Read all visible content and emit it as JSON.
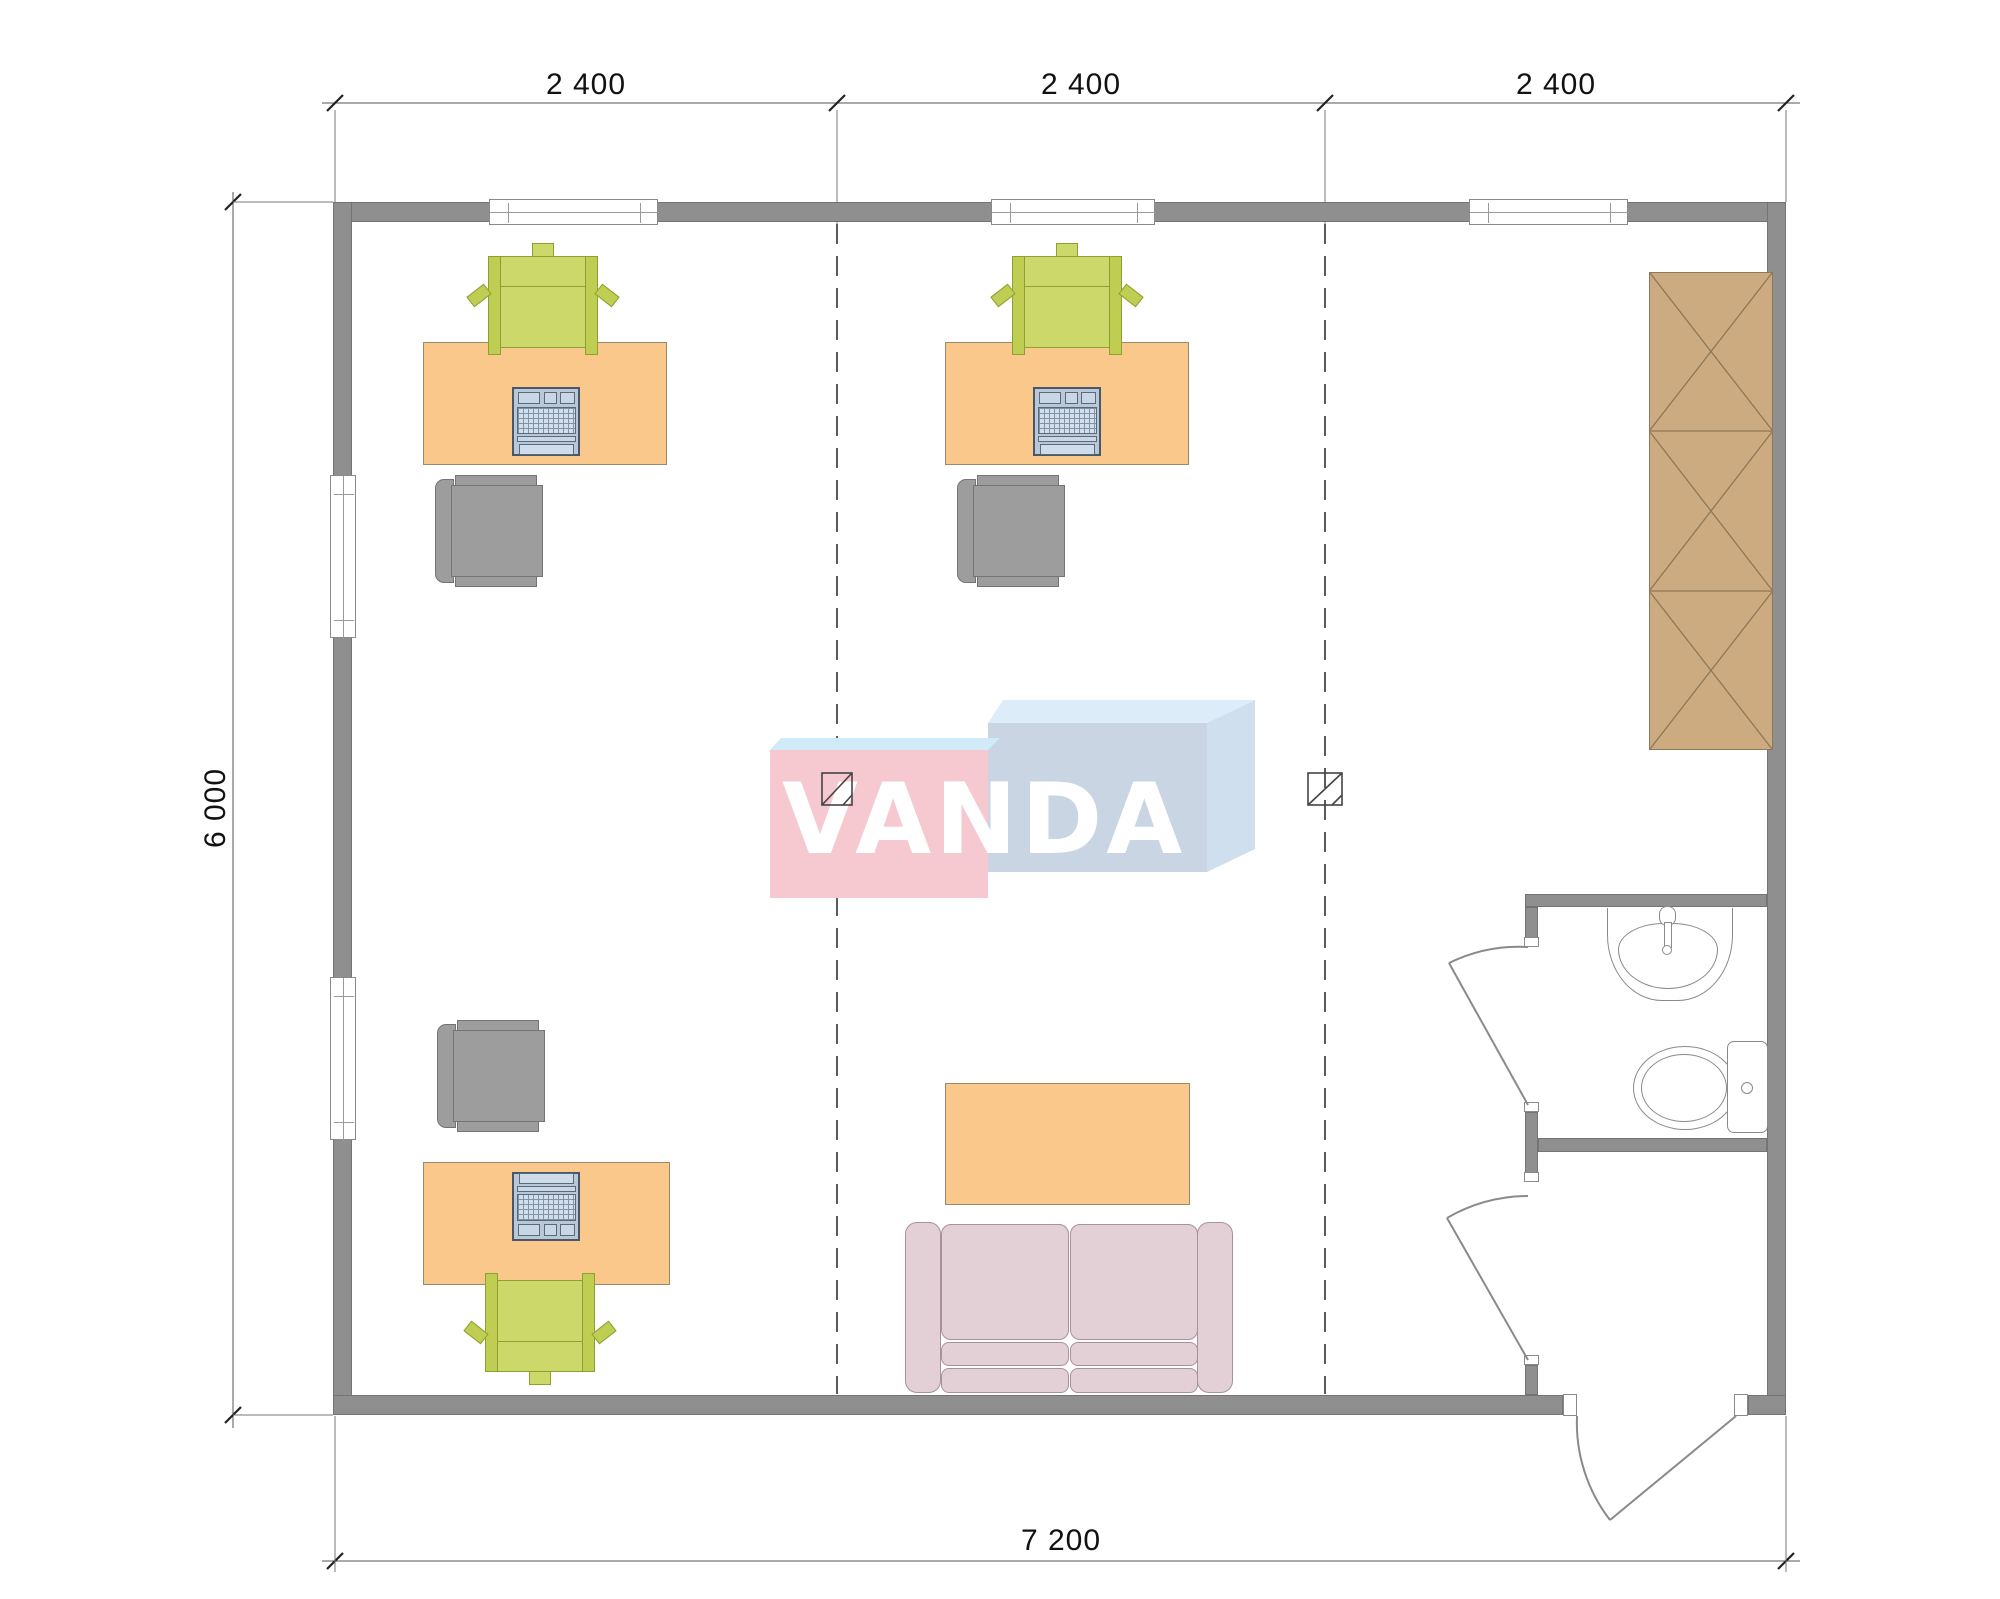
{
  "document": {
    "type": "architectural-floor-plan",
    "view": "top-down office module plan"
  },
  "dimensions": {
    "top_segments": [
      {
        "label": "2 400"
      },
      {
        "label": "2 400"
      },
      {
        "label": "2 400"
      }
    ],
    "left_total": {
      "label": "6 000"
    },
    "bottom_total": {
      "label": "7 200"
    }
  },
  "logo": {
    "text": "VANDA",
    "text_color": "#ffffff",
    "left_box_front": "#f6c8d0",
    "left_box_top": "#d0eaf7",
    "right_box_front": "#c9d5e3",
    "right_box_top": "#dcecf8",
    "right_box_side": "#d0dfee"
  },
  "colors": {
    "wall": "#8f8f8f",
    "desk": "#fbc88b",
    "visitor_chair_green": "#ccd96a",
    "task_chair_gray": "#9d9d9d",
    "laptop_body": "#b9c7d6",
    "cabinet_wood": "#cdab81",
    "sofa_pink": "#e2d0d6",
    "fixture_line": "#8a8a8a",
    "dimension_line": "#555555",
    "dashed_grid_line": "#333333",
    "text": "#111111"
  },
  "inventory": {
    "desks_with_laptops": 3,
    "green_visitor_chairs": 3,
    "gray_task_chairs": 3,
    "coffee_table": 1,
    "sofa": 1,
    "wardrobe_cabinet_sections": 3,
    "sink": 1,
    "toilet": 1,
    "windows_top": 3,
    "windows_left": 2,
    "interior_doors": 2,
    "exterior_doors": 1,
    "floor_outlet_symbols": 2
  }
}
